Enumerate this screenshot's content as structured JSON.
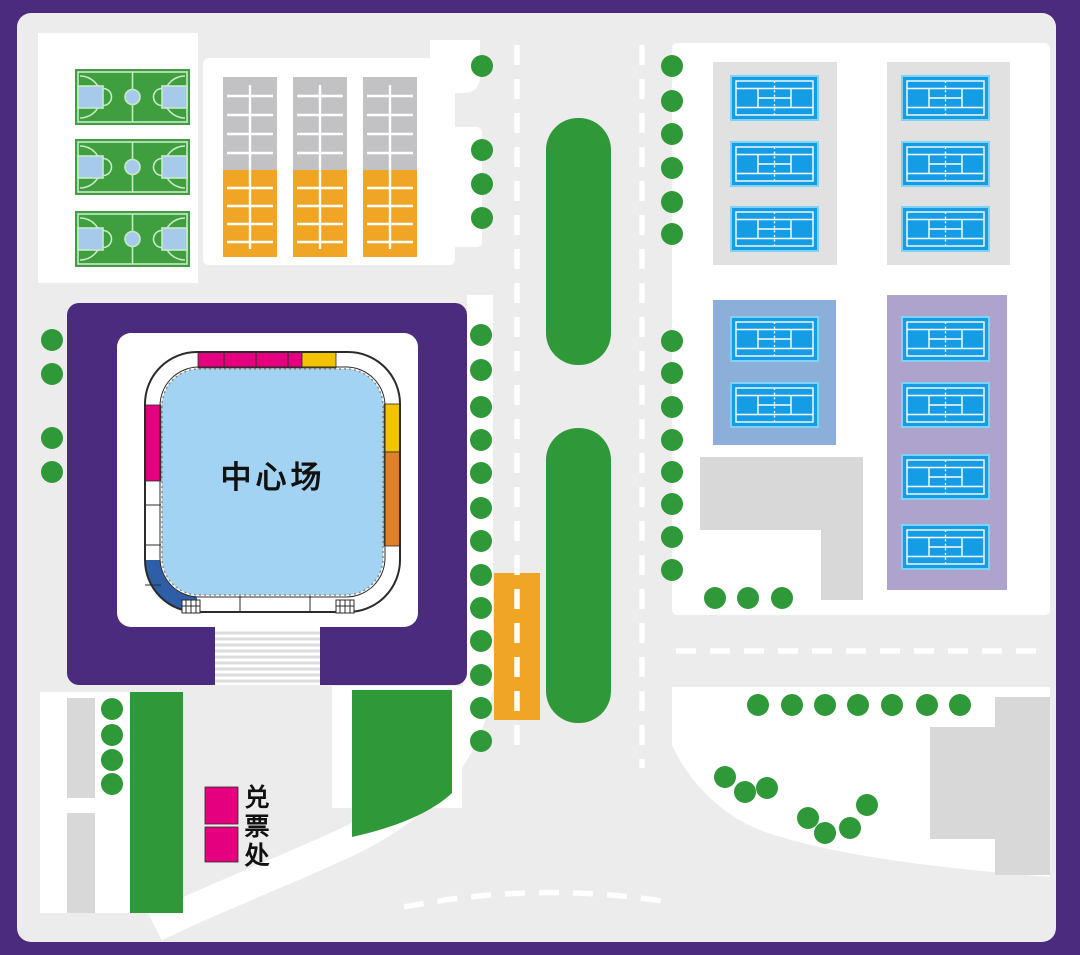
{
  "title": "tennis-center-site-map",
  "labels": {
    "center_court": "中心场",
    "ticket_office": "兑票处"
  },
  "colors": {
    "purple": "#4B2B7E",
    "bg": "#ECECEC",
    "white": "#FFFFFF",
    "building": "#D8D8D8",
    "panelgray": "#E1E1E1",
    "graycourt": "#C2C2C4",
    "amber": "#F0A524",
    "magenta": "#E4007F",
    "yellowseg": "#F3C300",
    "orangeseg": "#E0812A",
    "green": "#2F9838",
    "courtgreen": "#3F9F3F",
    "bballline": "#C9E9C9",
    "keyblue": "#A6CBEA",
    "tennis": "#149CE4",
    "tennisedge": "#7FD2F5",
    "steelblue": "#8BAFD9",
    "lavender": "#AEA3CD",
    "courtblue": "#A3D3F2",
    "segblue": "#2F5EA8",
    "stairline": "#DCDCDC",
    "ringline": "#2B2B2B"
  },
  "facilities": {
    "basketball_courts": 3,
    "training_courts": 3,
    "tennis_courts_top_zone": 6,
    "tennis_courts_blue_zone": 2,
    "tennis_courts_lavender_zone": 4,
    "ticket_booths": 2,
    "road_median_strips": 2,
    "trees": 56
  },
  "features": {
    "trees": {
      "symbol": "#sym-tree",
      "name": "tree-icon",
      "positions": [
        [
          52,
          340
        ],
        [
          52,
          374
        ],
        [
          52,
          438
        ],
        [
          52,
          472
        ],
        [
          482,
          66
        ],
        [
          482,
          150
        ],
        [
          482,
          184
        ],
        [
          482,
          218
        ],
        [
          481,
          335
        ],
        [
          481,
          370
        ],
        [
          481,
          407
        ],
        [
          481,
          440
        ],
        [
          481,
          473
        ],
        [
          481,
          508
        ],
        [
          481,
          541
        ],
        [
          481,
          575
        ],
        [
          481,
          608
        ],
        [
          481,
          641
        ],
        [
          481,
          675
        ],
        [
          481,
          708
        ],
        [
          481,
          741
        ],
        [
          672,
          66
        ],
        [
          672,
          101
        ],
        [
          672,
          134
        ],
        [
          672,
          168
        ],
        [
          672,
          202
        ],
        [
          672,
          234
        ],
        [
          672,
          341
        ],
        [
          672,
          373
        ],
        [
          672,
          407
        ],
        [
          672,
          440
        ],
        [
          672,
          472
        ],
        [
          672,
          504
        ],
        [
          672,
          537
        ],
        [
          672,
          570
        ],
        [
          112,
          709
        ],
        [
          112,
          735
        ],
        [
          112,
          760
        ],
        [
          112,
          784
        ],
        [
          715,
          598
        ],
        [
          748,
          598
        ],
        [
          782,
          598
        ],
        [
          758,
          705
        ],
        [
          792,
          705
        ],
        [
          825,
          705
        ],
        [
          858,
          705
        ],
        [
          892,
          705
        ],
        [
          927,
          705
        ],
        [
          960,
          705
        ],
        [
          725,
          777
        ],
        [
          745,
          792
        ],
        [
          767,
          788
        ],
        [
          808,
          818
        ],
        [
          825,
          833
        ],
        [
          850,
          828
        ],
        [
          867,
          805
        ]
      ]
    },
    "tennis_courts": {
      "symbol": "#sym-tennis",
      "name": "tennis-court",
      "positions": [
        [
          732,
          77
        ],
        [
          732,
          143
        ],
        [
          732,
          208
        ],
        [
          903,
          77
        ],
        [
          903,
          143
        ],
        [
          903,
          208
        ],
        [
          732,
          318
        ],
        [
          732,
          384
        ],
        [
          903,
          318
        ],
        [
          903,
          384
        ],
        [
          903,
          456
        ],
        [
          903,
          526
        ]
      ]
    },
    "basketball_courts": {
      "symbol": "#sym-bball",
      "name": "basketball-court",
      "positions": [
        [
          75,
          69
        ],
        [
          75,
          139
        ],
        [
          75,
          211
        ]
      ]
    },
    "stripe_courts": {
      "symbol": "#sym-stripe",
      "name": "training-court",
      "positions": [
        [
          223,
          77
        ],
        [
          293,
          77
        ],
        [
          363,
          77
        ]
      ]
    }
  }
}
